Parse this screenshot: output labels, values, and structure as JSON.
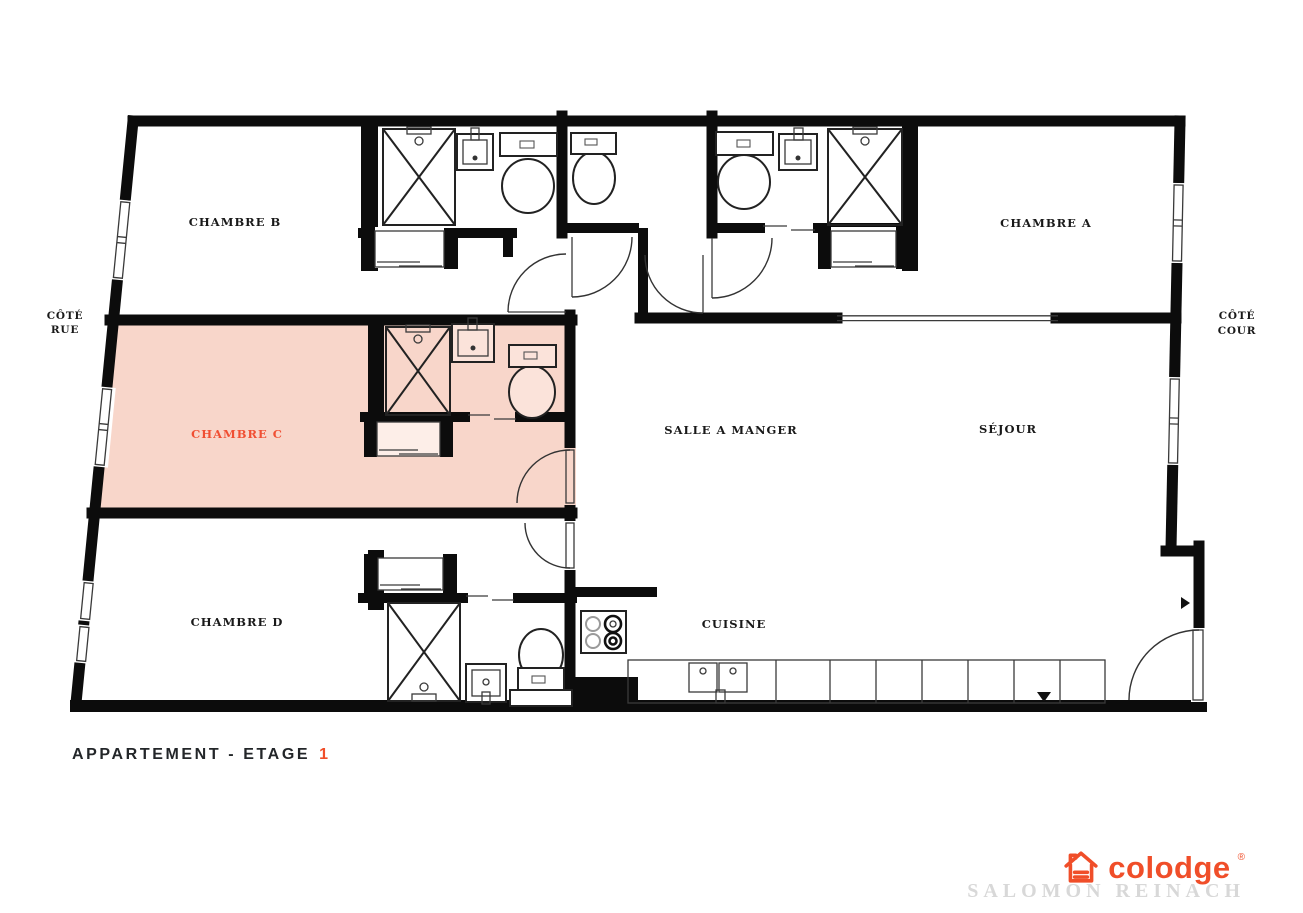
{
  "plan": {
    "rooms": [
      {
        "name": "chambre-b",
        "label": "CHAMBRE B"
      },
      {
        "name": "chambre-a",
        "label": "CHAMBRE A"
      },
      {
        "name": "chambre-c",
        "label": "CHAMBRE C",
        "highlighted": true
      },
      {
        "name": "chambre-d",
        "label": "CHAMBRE D"
      },
      {
        "name": "salle-a-manger",
        "label": "SALLE A MANGER"
      },
      {
        "name": "sejour",
        "label": "SÉJOUR"
      },
      {
        "name": "cuisine",
        "label": "CUISINE"
      }
    ],
    "side_labels": {
      "left_line1": "CÔTÉ",
      "left_line2": "RUE",
      "right_line1": "CÔTÉ",
      "right_line2": "COUR"
    }
  },
  "title": {
    "prefix": "APPARTEMENT - ETAGE",
    "floor": "1"
  },
  "branding": {
    "wordmark": "colodge",
    "trademark": "®",
    "residence": "SALOMON REINACH"
  },
  "colors": {
    "accent_orange": "#f04e29",
    "highlight_pink": "#f8d6ca",
    "wall_black": "#0c0c0c",
    "residence_gray": "#d8d8d8"
  }
}
